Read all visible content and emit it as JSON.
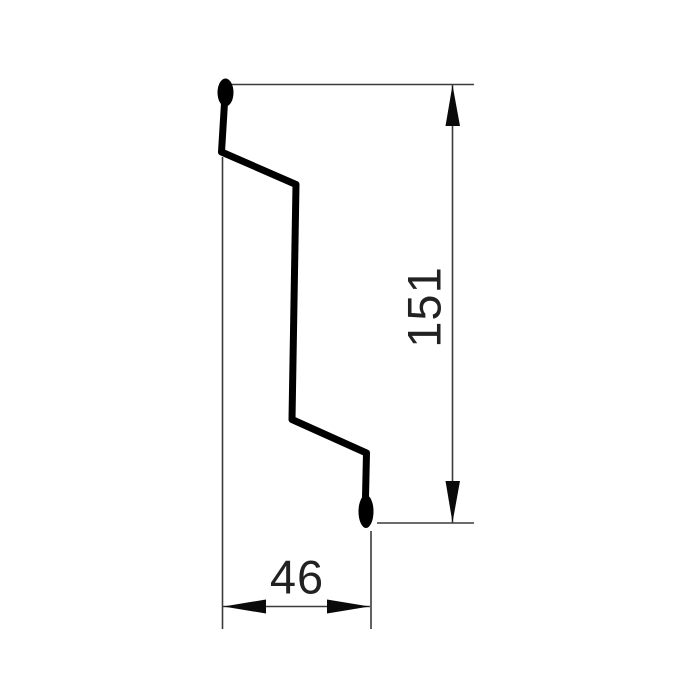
{
  "drawing": {
    "type": "profile-cross-section-technical-drawing",
    "labels": {
      "height_dimension": "151",
      "width_dimension": "46"
    },
    "colors": {
      "background": "#ffffff",
      "profile_stroke": "#000000",
      "dimension_line": "#3b3b3b",
      "arrow_fill": "#0a0a0a",
      "label_text": "#222222"
    }
  }
}
